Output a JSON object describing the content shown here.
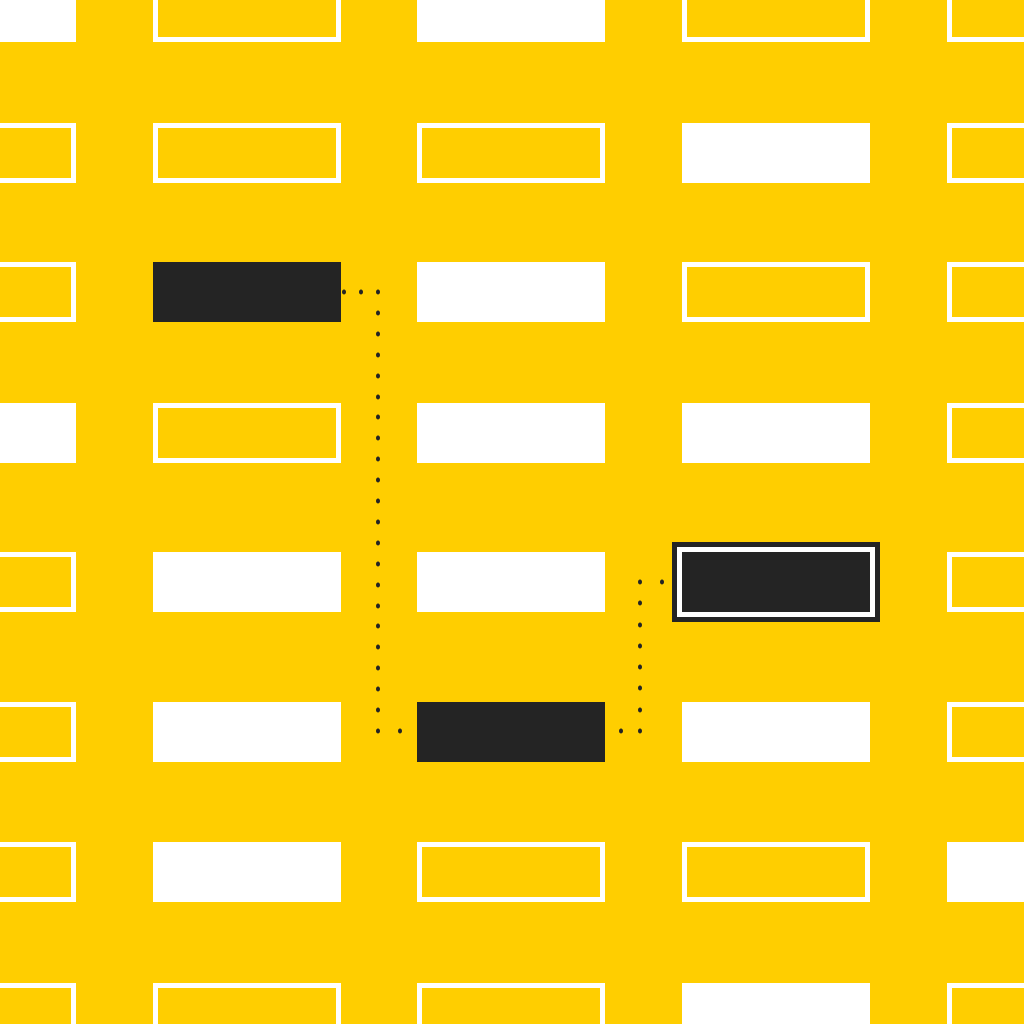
{
  "illustration": {
    "description": "abstract-grid-pattern-with-dotted-connectors",
    "background_color": "#FFCE00",
    "rect_fill_white": "#FFFFFF",
    "rect_fill_dark": "#242424",
    "outline_color": "#FFFFFF",
    "outline_width": 5,
    "rect_width": 188,
    "rect_height": 60,
    "column_x": [
      -112,
      153,
      417,
      682,
      947
    ],
    "row_y": [
      -18,
      123,
      262,
      403,
      552,
      702,
      842,
      983
    ],
    "cells": [
      [
        "white",
        "outlined",
        "white",
        "outlined",
        "outlined"
      ],
      [
        "outlined",
        "outlined",
        "outlined",
        "white",
        "outlined"
      ],
      [
        "outlined",
        "dark",
        "white",
        "outlined",
        "outlined"
      ],
      [
        "white",
        "outlined",
        "white",
        "white",
        "outlined"
      ],
      [
        "outlined",
        "white",
        "white",
        "dark-framed",
        "outlined"
      ],
      [
        "outlined",
        "white",
        "dark",
        "white",
        "outlined"
      ],
      [
        "outlined",
        "white",
        "outlined",
        "outlined",
        "white"
      ],
      [
        "outlined",
        "outlined",
        "outlined",
        "white",
        "outlined"
      ]
    ],
    "dark_framed": {
      "white_ring": 5,
      "dark_ring": 5
    },
    "connectors": [
      {
        "name": "connector-node1-to-node2",
        "dot_color": "#242424",
        "dot_width": 4,
        "dot_height": 5,
        "spacing": 21,
        "points": [
          [
            344,
            292
          ],
          [
            378,
            292
          ],
          [
            378,
            731
          ],
          [
            400,
            731
          ]
        ]
      },
      {
        "name": "connector-node2-to-node3",
        "dot_color": "#242424",
        "dot_width": 4,
        "dot_height": 5,
        "spacing": 21,
        "points": [
          [
            621,
            731
          ],
          [
            640,
            731
          ],
          [
            640,
            582
          ],
          [
            662,
            582
          ]
        ]
      }
    ]
  }
}
